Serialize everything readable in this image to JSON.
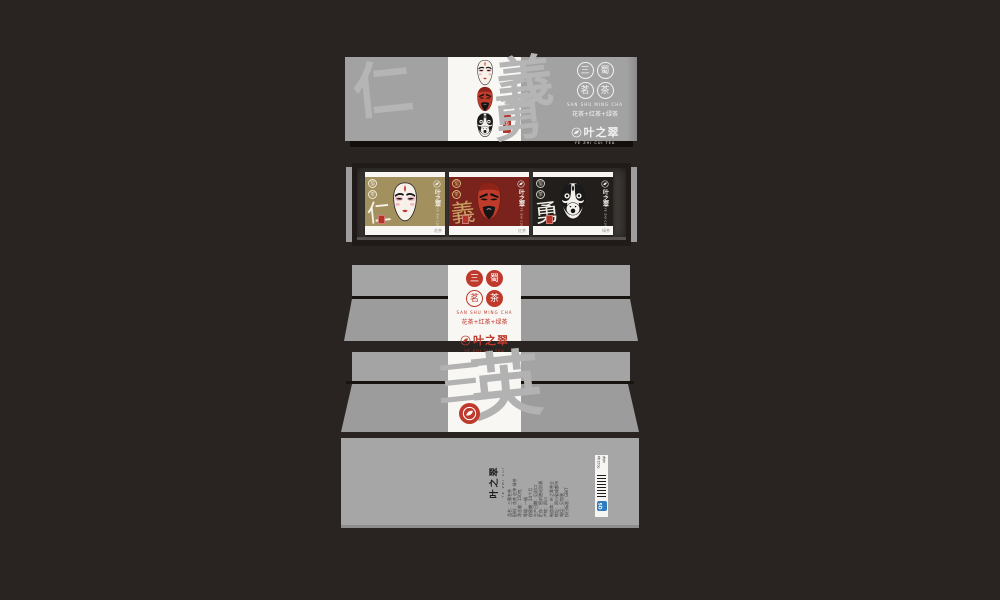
{
  "colors": {
    "background": "#292421",
    "panel_gray": "#a2a2a2",
    "strip_white": "#f8f7f4",
    "brand_red": "#bf3a2c",
    "stamp_red": "#b5342a",
    "pkg_gold": "#a3905f",
    "pkg_maroon": "#7a221c",
    "pkg_black": "#221e1b",
    "niche_dark": "#3c3835",
    "watermark_gray": "#b5b5b5",
    "qs_blue": "#2f7bbf"
  },
  "brand": {
    "seal_chars": [
      "三",
      "蜀",
      "茗",
      "茶"
    ],
    "series_en": "SAN SHU MING CHA",
    "series_cn": "花茶+红茶+绿茶",
    "logo_cn": "叶之翠",
    "logo_sub": "YE ZHI CUI TEA"
  },
  "panel1": {
    "watermark": [
      "仁",
      "義",
      "勇"
    ],
    "tag_label": "名茶"
  },
  "panel2": {
    "packages": [
      {
        "char": "仁",
        "flavor": "花茶",
        "mask": "liu-bei-mask"
      },
      {
        "char": "義",
        "flavor": "红茶",
        "mask": "guan-yu-mask"
      },
      {
        "char": "勇",
        "flavor": "绿茶",
        "mask": "zhang-fei-mask"
      }
    ]
  },
  "panel4": {
    "watermark": [
      "三",
      "英"
    ]
  },
  "panel5": {
    "logo_cn": "叶之翠",
    "logo_sub": "YE ZHI CUI",
    "info_lines": [
      "品名：三蜀名茶",
      "配料：花茶 红茶 绿茶",
      "净含量：150克",
      "等级：一级",
      "保质期：24个月",
      "生产日期：见封口",
      "贮存：密封避光防潮",
      "产地：四川",
      "制造商：叶之翠茶业",
      "地址：四川省成都市",
      "电话：见包装",
      "执行标准：GB/T"
    ],
    "net_weight": "净含量:150g",
    "qs_label": "QS"
  }
}
